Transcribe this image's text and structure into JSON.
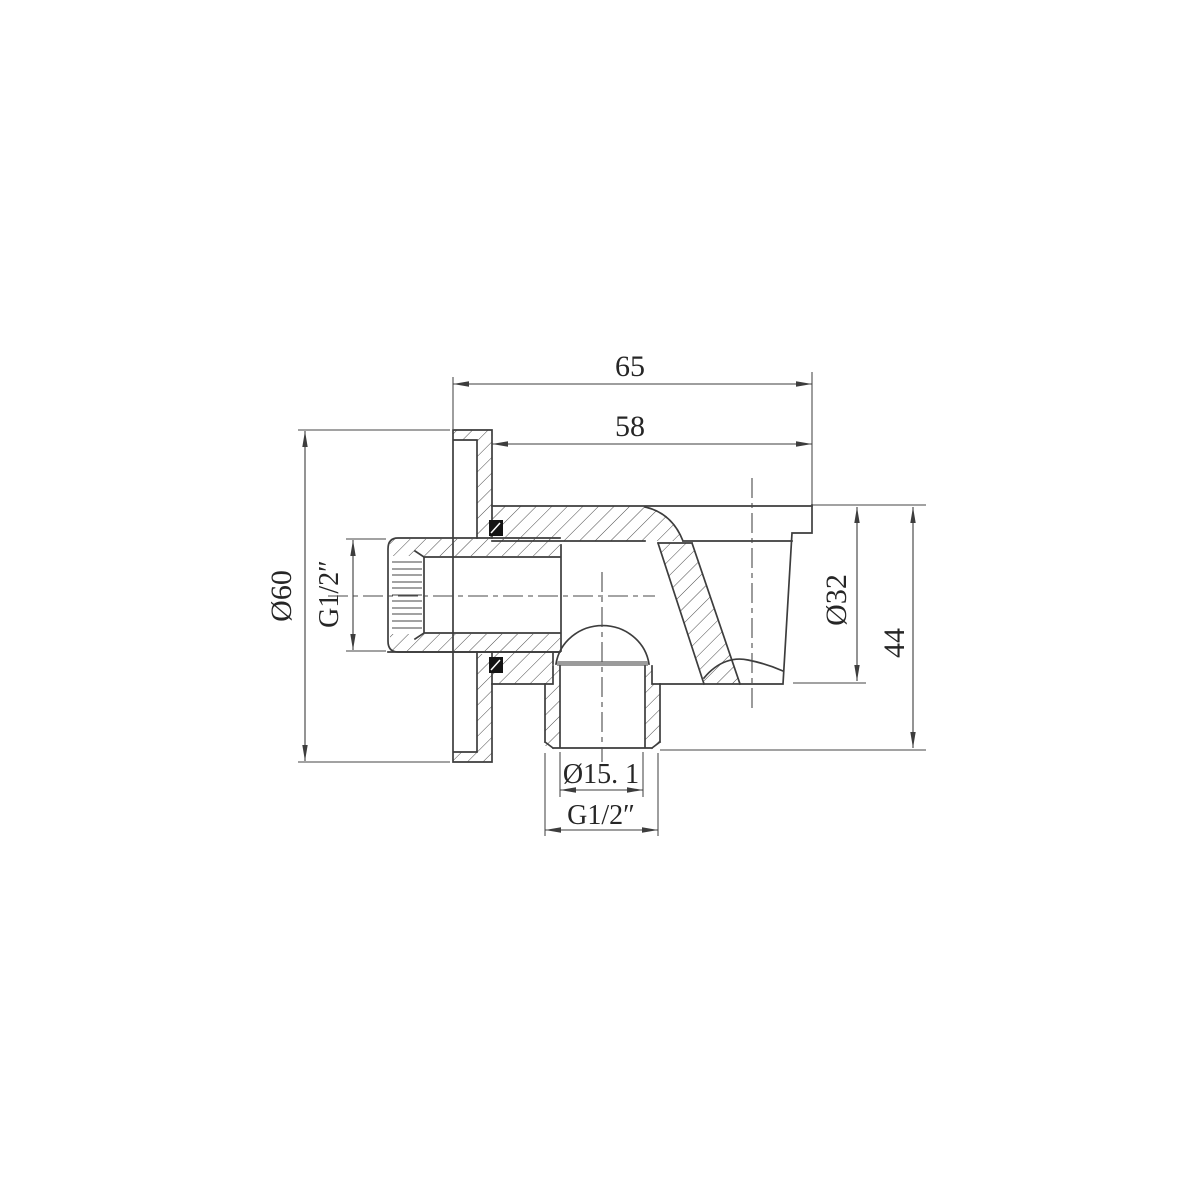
{
  "drawing": {
    "kind": "engineering-cross-section",
    "background": "#ffffff",
    "line_color": "#3d3d3d",
    "seal_color": "#141414",
    "thread_cap_color": "#9b9b9b"
  },
  "dims": {
    "overall_depth": {
      "label": "65"
    },
    "body_depth": {
      "label": "58"
    },
    "flange_diameter": {
      "label": "Ø60"
    },
    "inlet_thread": {
      "label": "G1/2″"
    },
    "cup_diameter": {
      "label": "Ø32"
    },
    "overall_height": {
      "label": "44"
    },
    "outlet_bore": {
      "label": "Ø15. 1"
    },
    "outlet_thread": {
      "label": "G1/2″"
    }
  }
}
